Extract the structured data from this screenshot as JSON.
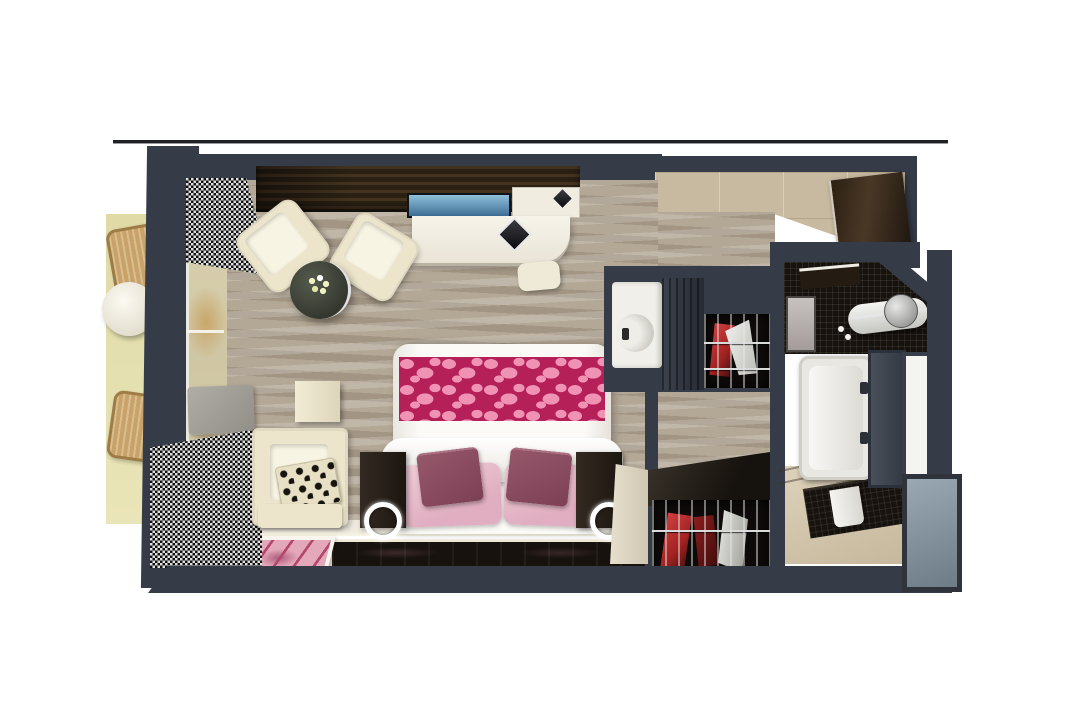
{
  "scene": {
    "type": "3d-floor-plan-render",
    "description_elements": [
      "balcony",
      "wicker-chair",
      "balcony-table",
      "sliding-window",
      "sheer-curtain",
      "tv-console",
      "tv-screen",
      "white-desk",
      "desk-stool",
      "decor-diamond",
      "lounge-armchair",
      "coffee-table",
      "flower-bouquet",
      "wall-shelf",
      "reading-armchair",
      "patterned-pillow",
      "ottoman",
      "area-rug",
      "double-bed",
      "bed-runner",
      "pink-pillows",
      "mauve-pillows",
      "nightstand",
      "ring-lamp",
      "minibar-fridge",
      "wardrobe-cabinet",
      "open-closet",
      "clothes-on-rail",
      "dressing-counter",
      "entry-door",
      "entry-tiles",
      "corridor-carpet",
      "bathroom",
      "mosaic-vanity",
      "vessel-sink",
      "faucet",
      "mirror",
      "bathtub",
      "shower-glass",
      "bathroom-door",
      "towel",
      "steel-panel"
    ]
  },
  "palette": {
    "bg": "#ffffff",
    "line": "#1f2125",
    "wall": "#353c48",
    "carpet": "#b3a795",
    "balcony": "#dfdaa6",
    "balconyHi": "#eae5b8",
    "wicker": "#c9a268",
    "wickerEdge": "#9e7c45",
    "cream": "#ece5cc",
    "creamHi": "#f8f4e4",
    "wood": "#2a2014",
    "woodHi": "#44331f",
    "door": "#4a3826",
    "doorDark": "#2b2013",
    "tvTop": "#8fc0da",
    "tvBot": "#3e6e95",
    "glassBeige": "#d8cfae",
    "glassAmber": "#c8a668",
    "sparkleDark": "#101010",
    "sparkleLight": "#e0e0e0",
    "runner": "#b62059",
    "pebble": "#ef92b4",
    "pillowPink": "#e0aec0",
    "pillowPinkHi": "#f0cdd8",
    "mauve": "#7c4054",
    "mauveHi": "#96576b",
    "ledge": "#efeadf",
    "ledWhite": "#ffffff",
    "glossy": "#17120e",
    "rugPink": "#e3a8ba",
    "rugStroke": "#b4476e",
    "rugWhite": "#f7f5ee",
    "closetBlack": "#0d0a09",
    "red": "#a32222",
    "redHi": "#d04040",
    "chrome": "#d9d9d9",
    "fridge": "#f1efe9",
    "tileEntry": "#c8baa0",
    "mosaic": "#17120d",
    "flower": "#edf2c0",
    "steel": "#9aa8b4",
    "steelDark": "#6e7c88",
    "panelFrame": "#2e333c"
  }
}
